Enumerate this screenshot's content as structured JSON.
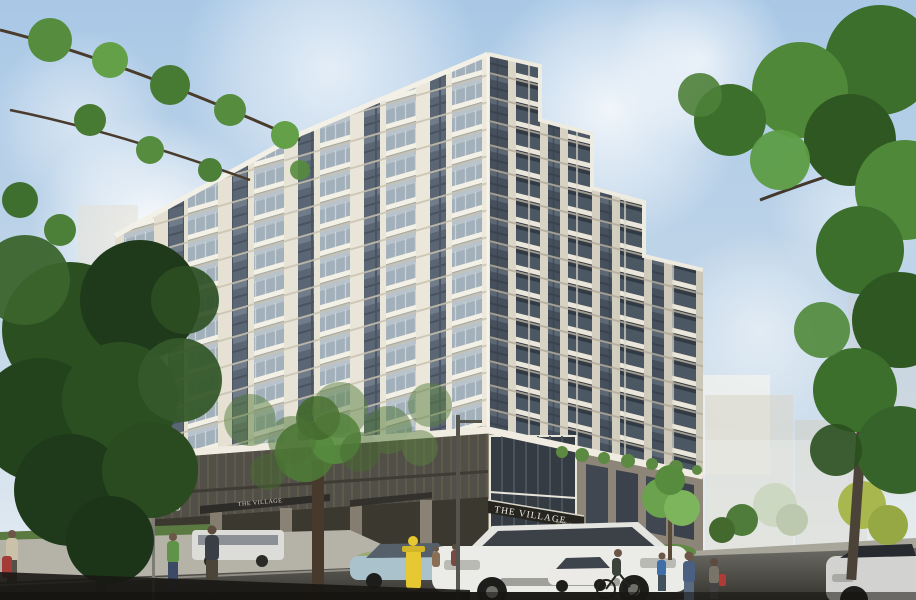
{
  "scene": {
    "description": "Sunny architectural rendering of a roughly 13-story cream apartment tower with stacked balconies rising from a dark brick parking podium at a street corner; leafy trees frame the left and right edges, a street with cars, a cyclist, pedestrians, a fire hydrant and a green street sign runs along the bottom.",
    "sky": "light blue with thin white clouds"
  },
  "signs": {
    "building_primary": "THE VILLAGE",
    "building_suffix": "on Western",
    "street_primary": "MYRTLE ST",
    "street_secondary": "8TH ST"
  },
  "colors": {
    "sky_top": "#a9c8e6",
    "sky_horizon": "#e8eef2",
    "facade_sunlit": "#eae6d9",
    "facade_shaded": "#dbd6c8",
    "window_glass": "#5a6674",
    "balcony_slab": "#f3f0e6",
    "podium_screen": "#514f47",
    "podium_brick": "#8d8577",
    "band_white": "#f0ece1",
    "foliage_dark": "#2c4f22",
    "foliage_bright": "#5c9c44",
    "road": "#4a4945",
    "sidewalk": "#b5b2a8",
    "street_sign_green": "#2f6b33",
    "hydrant_yellow": "#e8c832"
  },
  "objects": [
    {
      "name": "apartment-tower",
      "label": "cream residential tower with balconies"
    },
    {
      "name": "podium",
      "label": "dark parking podium with entrance canopies"
    },
    {
      "name": "building-sign",
      "label": "THE VILLAGE canopy sign"
    },
    {
      "name": "street-sign",
      "label": "green street name signs"
    },
    {
      "name": "white-suv",
      "label": "white SUV driving toward viewer"
    },
    {
      "name": "blue-sedan",
      "label": "light blue sedan"
    },
    {
      "name": "shuttle-van",
      "label": "white van on far street"
    },
    {
      "name": "white-car",
      "label": "white parked car"
    },
    {
      "name": "silver-car",
      "label": "silver car entering bottom right"
    },
    {
      "name": "cyclist",
      "label": "cyclist on road"
    },
    {
      "name": "pedestrians",
      "label": "people walking on sidewalks"
    },
    {
      "name": "fire-hydrant",
      "label": "yellow fire hydrant"
    },
    {
      "name": "trees",
      "label": "green framing trees and street planting"
    }
  ]
}
